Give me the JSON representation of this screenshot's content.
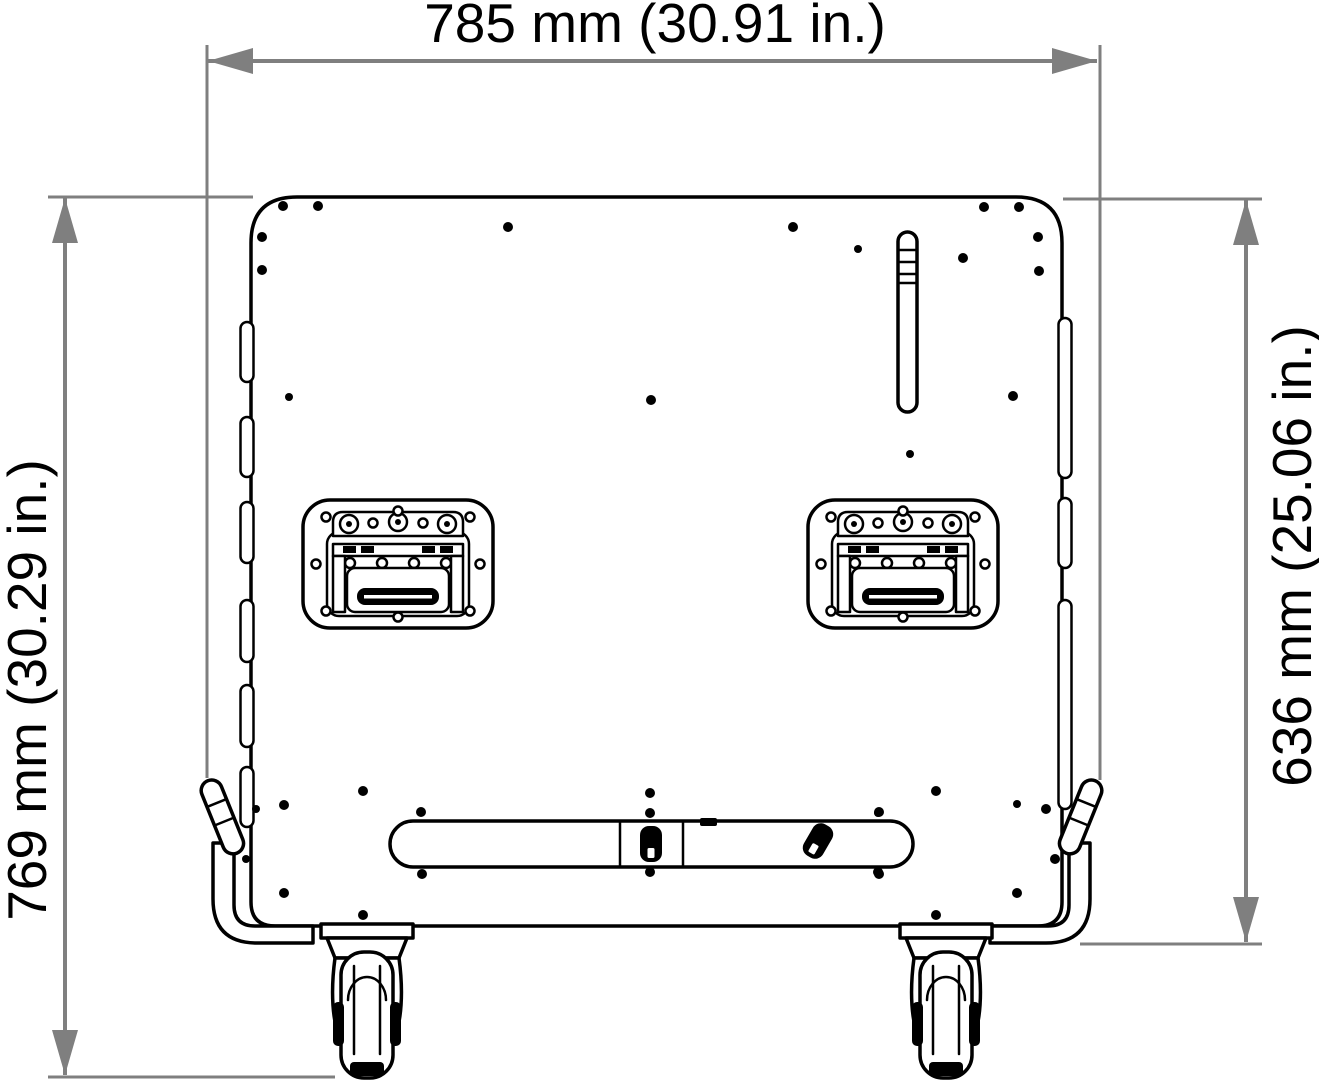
{
  "dimensions": {
    "width": {
      "label": "785 mm (30.91 in.)"
    },
    "height_overall": {
      "label": "769 mm (30.29 in.)"
    },
    "height_case": {
      "label": "636 mm (25.06 in.)"
    }
  },
  "colors": {
    "dimension_lines": "#7f7f7f",
    "drawing": "#000000",
    "background": "#ffffff"
  }
}
